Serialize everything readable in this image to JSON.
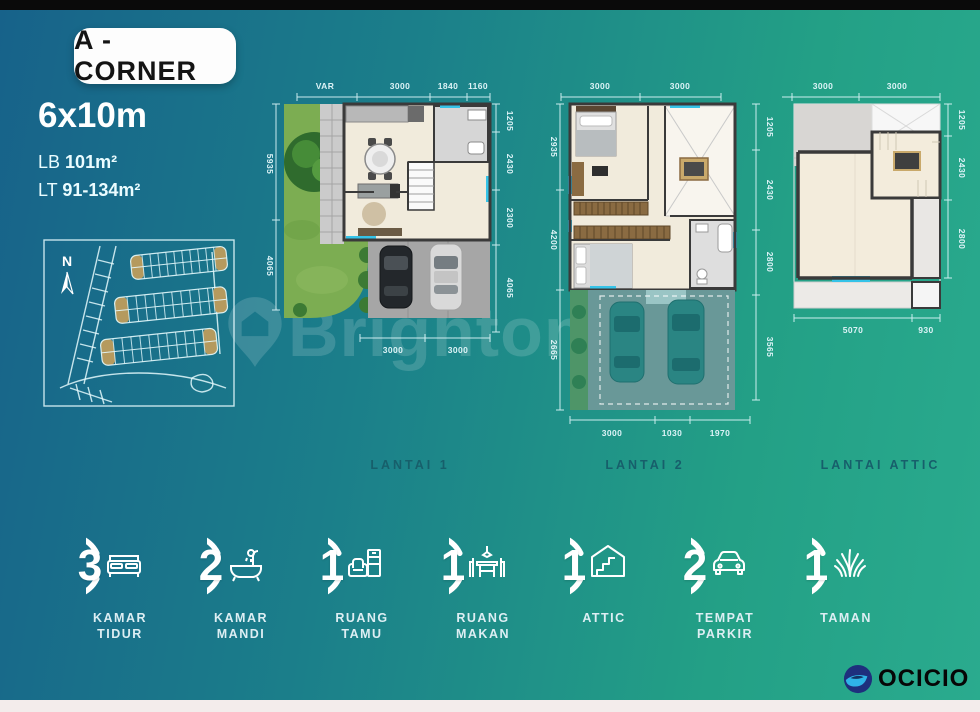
{
  "header": {
    "badge": "A - CORNER",
    "size": "6x10m",
    "lb_label": "LB",
    "lb_value": "101m²",
    "lt_label": "LT",
    "lt_value": "91-134m²"
  },
  "compass_label": "N",
  "watermark": {
    "brand": "Brighton",
    "code": "023"
  },
  "plans": {
    "lantai1": {
      "label": "LANTAI 1",
      "top_dims": [
        "VAR",
        "3000",
        "1840",
        "1160"
      ],
      "right_dims": [
        "1205",
        "2430",
        "2300",
        "4065"
      ],
      "left_dims": [
        "5935",
        "4065"
      ],
      "bottom_dims": [
        "3000",
        "3000"
      ]
    },
    "lantai2": {
      "label": "LANTAI 2",
      "top_dims": [
        "3000",
        "3000"
      ],
      "left_dims": [
        "2935",
        "4200",
        "2665"
      ],
      "right_dims": [
        "1205",
        "2430",
        "2800",
        "3565"
      ],
      "bottom_dims": [
        "3000",
        "1030",
        "1970"
      ]
    },
    "attic": {
      "label": "LANTAI ATTIC",
      "top_dims": [
        "3000",
        "3000"
      ],
      "right_dims": [
        "1205",
        "2430",
        "2800"
      ],
      "bottom_dims": [
        "5070",
        "930"
      ]
    }
  },
  "features": [
    {
      "count": "3",
      "line1": "KAMAR",
      "line2": "TIDUR",
      "icon": "bed"
    },
    {
      "count": "2",
      "line1": "KAMAR",
      "line2": "MANDI",
      "icon": "bathtub"
    },
    {
      "count": "1",
      "line1": "RUANG",
      "line2": "TAMU",
      "icon": "sofa"
    },
    {
      "count": "1",
      "line1": "RUANG",
      "line2": "MAKAN",
      "icon": "dining-table"
    },
    {
      "count": "1",
      "line1": "ATTIC",
      "line2": "",
      "icon": "attic-house"
    },
    {
      "count": "2",
      "line1": "TEMPAT",
      "line2": "PARKIR",
      "icon": "car"
    },
    {
      "count": "1",
      "line1": "TAMAN",
      "line2": "",
      "icon": "grass"
    }
  ],
  "logo": {
    "name": "OCICIO"
  }
}
